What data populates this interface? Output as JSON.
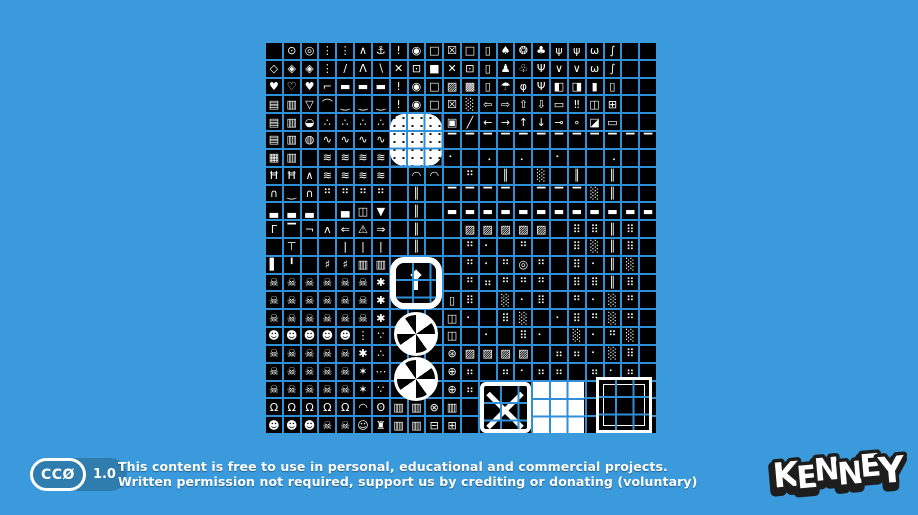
{
  "page": {
    "background_color": "#3a9adc",
    "grid_gap_color": "#2f8fd8",
    "tile_color": "#000000",
    "pixel_color": "#ffffff"
  },
  "license": {
    "badge_left": "CCØ",
    "badge_right": "1.0",
    "line1": "This content is free to use in personal, educational and commercial projects.",
    "line2": "Written permission not required, support us by crediting or donating (voluntary)"
  },
  "logo": {
    "text": "KENNEY",
    "letters": [
      "K",
      "E",
      "N",
      "N",
      "E",
      "Y"
    ]
  },
  "sheet": {
    "name": "1-bit monochrome tilesheet preview",
    "columns": 22,
    "rows": 22,
    "features": [
      {
        "name": "speckled-white-blob-tile"
      },
      {
        "name": "rounded-track-ring-tile"
      },
      {
        "name": "statue-icon"
      },
      {
        "name": "fan-turbine-tile-top"
      },
      {
        "name": "fan-turbine-tile-bottom"
      },
      {
        "name": "x-braced-crate-tile"
      },
      {
        "name": "solid-white-tile"
      },
      {
        "name": "black-framed-tile"
      }
    ],
    "grid": [
      [
        "",
        "⊙",
        "◎",
        "⋮",
        "⋮",
        "∧",
        "⚓",
        "!",
        "◉",
        "□",
        "☒",
        "□",
        "▯",
        "♠",
        "❂",
        "♣",
        "ψ",
        "ψ",
        "ω",
        "∫",
        "",
        ""
      ],
      [
        "◇",
        "◈",
        "◈",
        "⋮",
        "∕",
        "Λ",
        "∖",
        "✕",
        "⊡",
        "■",
        "✕",
        "⊡",
        "▯",
        "♟",
        "♧",
        "Ψ",
        "∨",
        "∨",
        "ω",
        "∫",
        "",
        ""
      ],
      [
        "♥",
        "♡",
        "♥",
        "⌐",
        "▬",
        "▬",
        "▬",
        "!",
        "◉",
        "□",
        "▨",
        "▩",
        "▯",
        "☂",
        "φ",
        "Ψ",
        "◧",
        "◨",
        "▮",
        "▯",
        "",
        ""
      ],
      [
        "▤",
        "▥",
        "▽",
        "⌒",
        "‿",
        "‿",
        "‿",
        "!",
        "◉",
        "□",
        "☒",
        "░",
        "⇦",
        "⇨",
        "⇧",
        "⇩",
        "▭",
        "‼",
        "◫",
        "⊞",
        "",
        ""
      ],
      [
        "▤",
        "▥",
        "◒",
        "∴",
        "∴",
        "∴",
        "∴",
        "",
        "",
        "",
        "▣",
        "╱",
        "←",
        "→",
        "↑",
        "↓",
        "⊸",
        "∘",
        "◪",
        "▭",
        "",
        ""
      ],
      [
        "▤",
        "▥",
        "◍",
        "∿",
        "∿",
        "∿",
        "∿",
        "",
        "",
        "",
        "▔",
        "▔",
        "▔",
        "▔",
        "▔",
        "▔",
        "▔",
        "▔",
        "▔",
        "▔",
        "▔",
        "▔"
      ],
      [
        "▦",
        "▥",
        "",
        "≋",
        "≋",
        "≋",
        "≋",
        "",
        "",
        "",
        "⠂",
        "",
        "⠠",
        "",
        "⠄",
        "",
        "⠂",
        "",
        "",
        "⠠",
        "",
        ""
      ],
      [
        "Ħ",
        "Ħ",
        "∧",
        "≋",
        "≋",
        "≋",
        "≋",
        "",
        "◠",
        "◠",
        "",
        "⠛",
        "",
        "║",
        "",
        "░",
        "",
        "║",
        "",
        "║",
        "",
        ""
      ],
      [
        "∩",
        "‿",
        "∩",
        "⠛",
        "⠛",
        "⠛",
        "⠛",
        "",
        "║",
        "",
        "▔",
        "▔",
        "▔",
        "▔",
        "",
        "▔",
        "▔",
        "▔",
        "░",
        "║",
        "",
        ""
      ],
      [
        "▃",
        "▃",
        "▃",
        "",
        "▄",
        "◫",
        "▼",
        "",
        "║",
        "",
        "▬",
        "▬",
        "▬",
        "▬",
        "▬",
        "▬",
        "▬",
        "▬",
        "▬",
        "▬",
        "▬",
        "▬"
      ],
      [
        "Γ",
        "▔",
        "¬",
        "ʌ",
        "⇐",
        "⚠",
        "⇒",
        "",
        "║",
        "",
        "",
        "▨",
        "▨",
        "▨",
        "▨",
        "▨",
        "",
        "⠿",
        "⠿",
        "║",
        "⠿",
        ""
      ],
      [
        "",
        "⊤",
        "",
        "",
        "|",
        "|",
        "|",
        "",
        "║",
        "",
        "",
        "⠛",
        "⠂",
        "",
        "⠛",
        "",
        "",
        "⠿",
        "░",
        "║",
        "⠿",
        ""
      ],
      [
        "▌",
        "╹",
        "",
        "♯",
        "♯",
        "▥",
        "▥",
        "",
        "",
        "",
        "",
        "⠛",
        "⠂",
        "⠛",
        "◎",
        "⠛",
        "",
        "⠿",
        "⠂",
        "║",
        "░",
        ""
      ],
      [
        "☠",
        "☠",
        "☠",
        "☠",
        "☠",
        "☠",
        "✱",
        "",
        "",
        "",
        "",
        "⠛",
        "⠶",
        "⠛",
        "⠛",
        "⠛",
        "",
        "⠿",
        "⠿",
        "║",
        "⠿",
        ""
      ],
      [
        "☠",
        "☠",
        "☠",
        "☠",
        "☠",
        "☠",
        "✱",
        "",
        "",
        "",
        "▯",
        "⠿",
        "",
        "░",
        "⠂",
        "⠿",
        "",
        "⠛",
        "⠂",
        "░",
        "⠛",
        ""
      ],
      [
        "☠",
        "☠",
        "☠",
        "☠",
        "☠",
        "☠",
        "✱",
        "",
        "",
        "",
        "◫",
        "⠂",
        "",
        "⠿",
        "░",
        "",
        "⠂",
        "⠿",
        "⠛",
        "░",
        "⠛",
        ""
      ],
      [
        "☻",
        "☻",
        "☻",
        "☻",
        "☻",
        "⋮",
        "∵",
        "",
        "",
        "",
        "◫",
        "",
        "⠂",
        "",
        "⠿",
        "⠂",
        "",
        "░",
        "⠂",
        "⠛",
        "░",
        ""
      ],
      [
        "☠",
        "☠",
        "☠",
        "☠",
        "☠",
        "✱",
        "∴",
        "",
        "",
        "",
        "⊛",
        "▨",
        "▨",
        "▨",
        "▨",
        "",
        "⠶",
        "⠶",
        "⠂",
        "░",
        "⠿",
        ""
      ],
      [
        "☠",
        "☠",
        "☠",
        "☠",
        "☠",
        "✶",
        "⋯",
        "",
        "",
        "",
        "⊕",
        "⠶",
        "",
        "⠶",
        "⠂",
        "⠶",
        "⠶",
        "",
        "⠶",
        "⠂",
        "⠶",
        ""
      ],
      [
        "☠",
        "☠",
        "☠",
        "☠",
        "☠",
        "✶",
        "∵",
        "",
        "",
        "",
        "⊕",
        "⠶",
        "",
        "",
        "",
        "",
        "",
        "",
        "",
        "",
        "",
        ""
      ],
      [
        "Ω",
        "Ω",
        "Ω",
        "Ω",
        "Ω",
        "◠",
        "ʘ",
        "▥",
        "▥",
        "⊗",
        "▥",
        "",
        "",
        "",
        "",
        "",
        "",
        "",
        "",
        "",
        "",
        ""
      ],
      [
        "☻",
        "☻",
        "☻",
        "☠",
        "☠",
        "☺",
        "♜",
        "▥",
        "▥",
        "⊟",
        "⊞",
        "",
        "",
        "",
        "",
        "",
        "",
        "",
        "",
        "",
        "",
        ""
      ]
    ]
  }
}
